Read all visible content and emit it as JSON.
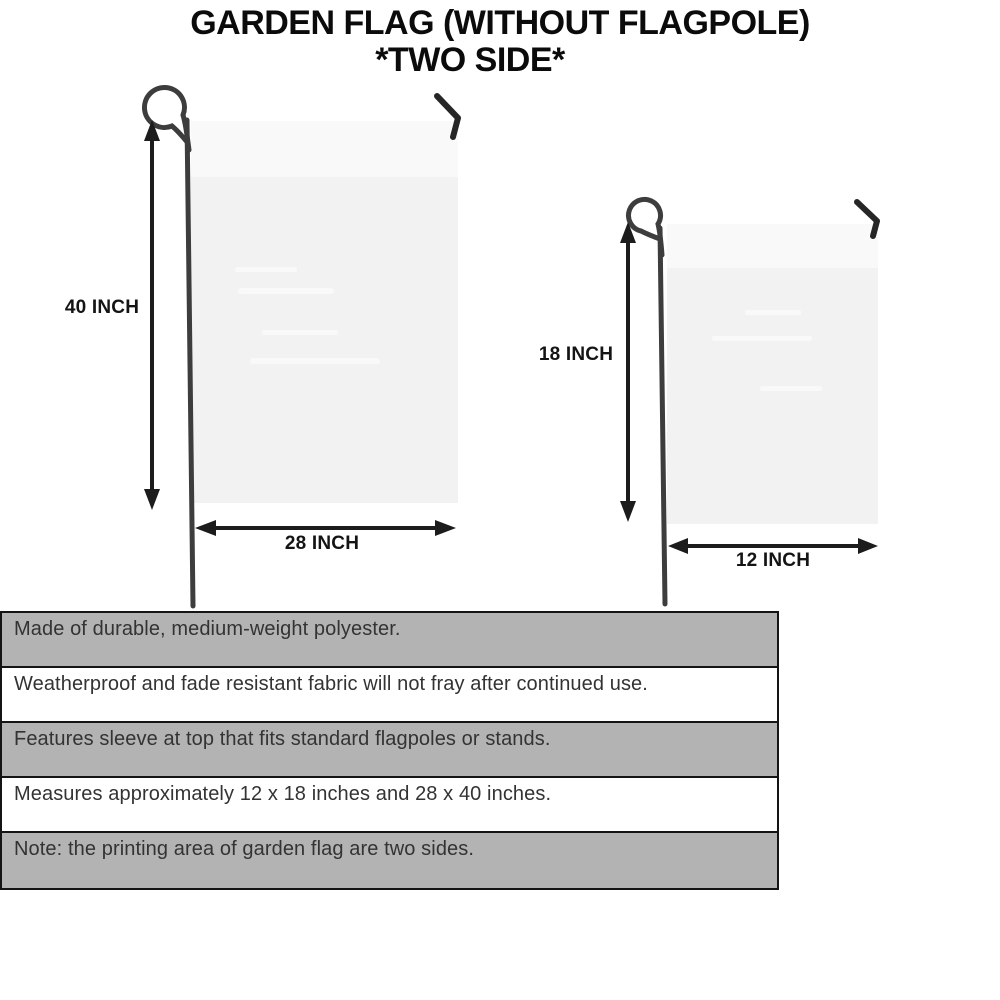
{
  "title": {
    "line1": "GARDEN FLAG (WITHOUT FLAGPOLE)",
    "line2": "*TWO SIDE*"
  },
  "diagram": {
    "large_flag": {
      "height_label": "40 INCH",
      "width_label": "28 INCH"
    },
    "small_flag": {
      "height_label": "18 INCH",
      "width_label": "12 INCH"
    }
  },
  "features": [
    {
      "text": "Made of durable, medium-weight polyester."
    },
    {
      "text": "Weatherproof and fade resistant fabric will not fray after continued use."
    },
    {
      "text": "Features sleeve at top that fits standard flagpoles or stands."
    },
    {
      "text": "Measures approximately 12 x 18 inches and 28 x 40 inches."
    },
    {
      "text": "Note: the printing area of garden flag are two sides."
    }
  ],
  "colors": {
    "row_gray": "#b3b3b3",
    "flag_fill": "#f2f2f3",
    "pole": "#3d3d3d",
    "ink": "#1c1c1c",
    "border": "#141414",
    "text": "#333333"
  }
}
